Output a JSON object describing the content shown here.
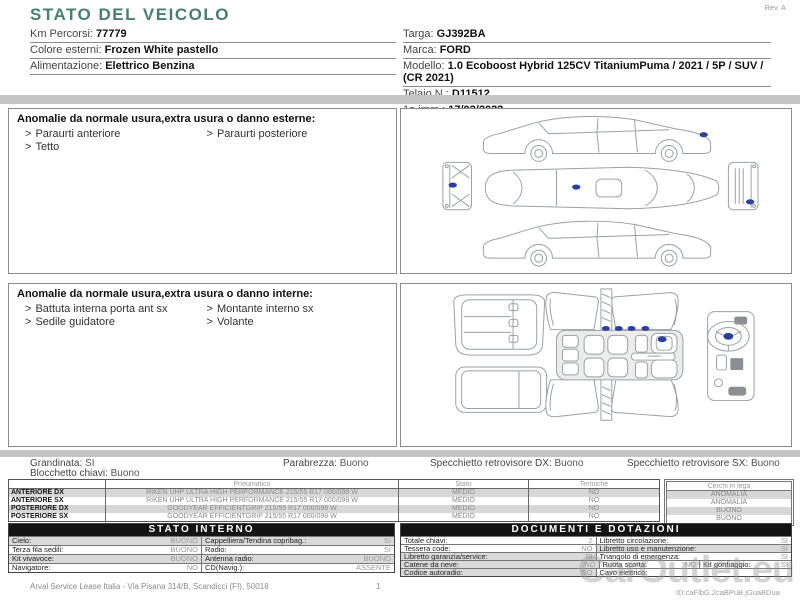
{
  "bullet": ">",
  "report": {
    "title": "STATO DEL VEICOLO",
    "rev": "Rev. A",
    "vehicle_left": [
      {
        "label": "Km Percorsi:",
        "value": "77779"
      },
      {
        "label": "Colore esterni:",
        "value": "Frozen White pastello"
      },
      {
        "label": "Alimentazione:",
        "value": "Elettrico Benzina"
      }
    ],
    "vehicle_right": [
      {
        "label": "Targa:",
        "value": "GJ392BA"
      },
      {
        "label": "Marca:",
        "value": "FORD"
      },
      {
        "label": "Modello:",
        "value": "1.0 Ecoboost Hybrid 125CV TitaniumPuma / 2021 / 5P / SUV / (CR 2021)"
      },
      {
        "label": "Telaio N.:",
        "value": "D11512"
      },
      {
        "label": "1a imm.:",
        "value": "17/02/2022"
      }
    ]
  },
  "external_anomalies": {
    "title": "Anomalie da normale usura,extra usura o danno esterne:",
    "items": [
      "Paraurti anteriore",
      "Paraurti posteriore",
      "Tetto"
    ]
  },
  "internal_anomalies": {
    "title": "Anomalie da normale usura,extra usura o danno interne:",
    "items": [
      "Battuta interna porta ant sx",
      "Montante interno sx",
      "Sedile guidatore",
      "Volante"
    ]
  },
  "summary": {
    "grandinata": {
      "label": "Grandinata:",
      "value": "SI"
    },
    "parabrezza": {
      "label": "Parabrezza:",
      "value": "Buono"
    },
    "specchietto_dx": {
      "label": "Specchietto retrovisore DX:",
      "value": "Buono"
    },
    "specchietto_sx": {
      "label": "Specchietto retrovisore SX:",
      "value": "Buono"
    },
    "blocchetto_chiavi": {
      "label": "Blocchetto chiavi:",
      "value": "Buono"
    }
  },
  "tyres": {
    "col_pneumatico": "Pneumatico",
    "col_stato": "Stato",
    "col_termiche": "Termiche",
    "col_cerchi": "Cerchi in lega",
    "rows": [
      {
        "position": "ANTERIORE DX",
        "pneumatico": "RIKEN UHP ULTRA HIGH PERFORMANCE 215/55 R17 000/098 W",
        "stato": "MEDIO",
        "termiche": "NO",
        "cerchi": "ANOMALIA"
      },
      {
        "position": "ANTERIORE SX",
        "pneumatico": "RIKEN UHP ULTRA HIGH PERFORMANCE 215/55 R17 000/098 W",
        "stato": "MEDIO",
        "termiche": "NO",
        "cerchi": "ANOMALIA"
      },
      {
        "position": "POSTERIORE DX",
        "pneumatico": "GOODYEAR EFFICIENTGRIP 215/55 R17 000/098 W",
        "stato": "MEDIO",
        "termiche": "NO",
        "cerchi": "BUONO"
      },
      {
        "position": "POSTERIORE SX",
        "pneumatico": "GOODYEAR EFFICIENTGRIP 215/55 R17 000/098 W",
        "stato": "MEDIO",
        "termiche": "NO",
        "cerchi": "BUONO"
      }
    ]
  },
  "stato_interno": {
    "title": "STATO INTERNO",
    "rows": [
      {
        "l_label": "Cielo:",
        "l_value": "BUONO",
        "r_label": "Cappelliera/Tendina copribag.:",
        "r_value": "SI"
      },
      {
        "l_label": "Terza fila sedili:",
        "l_value": "BUONO",
        "r_label": "Radio:",
        "r_value": "SI"
      },
      {
        "l_label": "Kit vivavoce:",
        "l_value": "BUONO",
        "r_label": "Antenna radio:",
        "r_value": "BUONO"
      },
      {
        "l_label": "Navigatore:",
        "l_value": "NO",
        "r_label": "CD(Navig.):",
        "r_value": "ASSENTE"
      }
    ]
  },
  "documenti": {
    "title": "DOCUMENTI E DOTAZIONI",
    "rows": [
      {
        "l_label": "Totale chiavi:",
        "l_value": "2",
        "r_label": "Libretto circolazione:",
        "r_value": "SI"
      },
      {
        "l_label": "Tessera code:",
        "l_value": "NO",
        "r_label": "Libretto uso e manutenzione:",
        "r_value": "SI"
      },
      {
        "l_label": "Libretto garanzia/service:",
        "l_value": "SI",
        "r_label": "Triangolo di emergenza:",
        "r_value": "SI"
      },
      {
        "l_label": "Catene da neve:",
        "l_value": "NO",
        "r_label": "Ruota scorta:",
        "r_value": "NO",
        "r2_label": "Kit gonfiaggio:",
        "r2_value": "SI"
      },
      {
        "l_label": "Codice autoradio:",
        "l_value": "NO",
        "r_label": "Cavo elettrico:",
        "r_value": ""
      }
    ]
  },
  "footer": {
    "company": "Arval Service Lease Italia - Via Pisana 314/B, Scandicci (FI), 50018",
    "page": "1"
  },
  "watermark": {
    "brand": "CarOutlet.eu",
    "id_line": "ID:caFlbG.2caBPuB.jGuaBDua"
  },
  "colors": {
    "title_teal": "#47806f",
    "damage_marker": "#2b3f9e"
  }
}
